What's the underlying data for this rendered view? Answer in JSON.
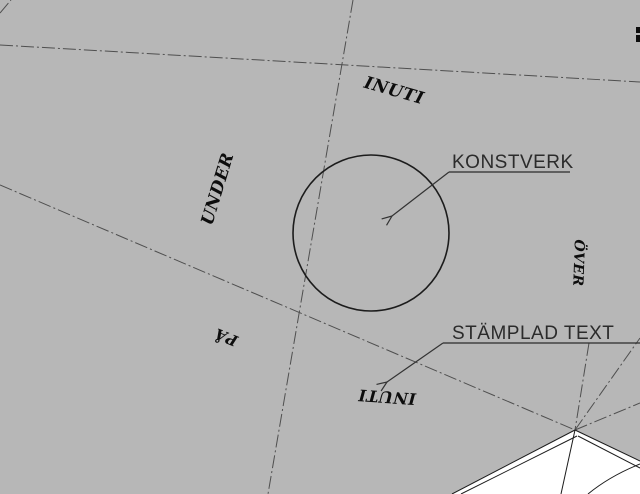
{
  "drawing": {
    "type": "cad-site-plan",
    "background_color": "#b7b7b7",
    "annotations": {
      "konstverk_label": "KONSTVERK",
      "stamplad_text_label": "STÄMPLAD TEXT"
    },
    "stamps": [
      {
        "name": "inuti-top",
        "text": "INUTI"
      },
      {
        "name": "under",
        "text": "UNDER"
      },
      {
        "name": "over",
        "text": "ÖVER"
      },
      {
        "name": "pa",
        "text": "PÅ"
      },
      {
        "name": "inuti-bottom",
        "text": "INUTI"
      }
    ],
    "colors": {
      "background": "#b7b7b7",
      "stamp_ink": "#0d0d0d",
      "label_ink": "#2b2b2b",
      "boundary_line": "#4f4f4f",
      "outline": "#1c1c1c",
      "building_fill": "#ffffff"
    }
  }
}
